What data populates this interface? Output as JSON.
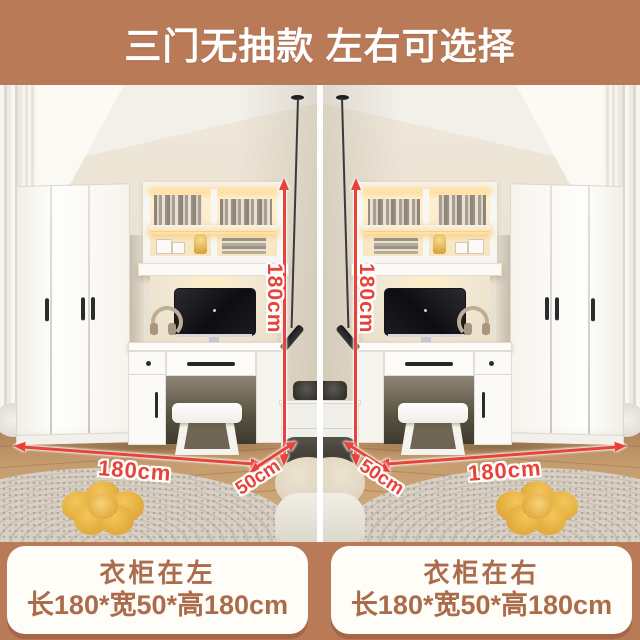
{
  "banner": {
    "title": "三门无抽款 左右可选择"
  },
  "panels": [
    {
      "side": "left",
      "height_label": "180cm",
      "width_label": "180cm",
      "depth_label": "50cm",
      "caption_title": "衣柜在左",
      "caption_size": "长180*宽50*高180cm"
    },
    {
      "side": "right",
      "height_label": "180cm",
      "width_label": "180cm",
      "depth_label": "50cm",
      "caption_title": "衣柜在右",
      "caption_size": "长180*宽50*高180cm"
    }
  ],
  "colors": {
    "banner_bg": "#b97a58",
    "dimension_red": "#e8433a",
    "caption_text": "#ab6c4c",
    "caption_bg": "#fffdf8",
    "divider": "#ffffff"
  }
}
